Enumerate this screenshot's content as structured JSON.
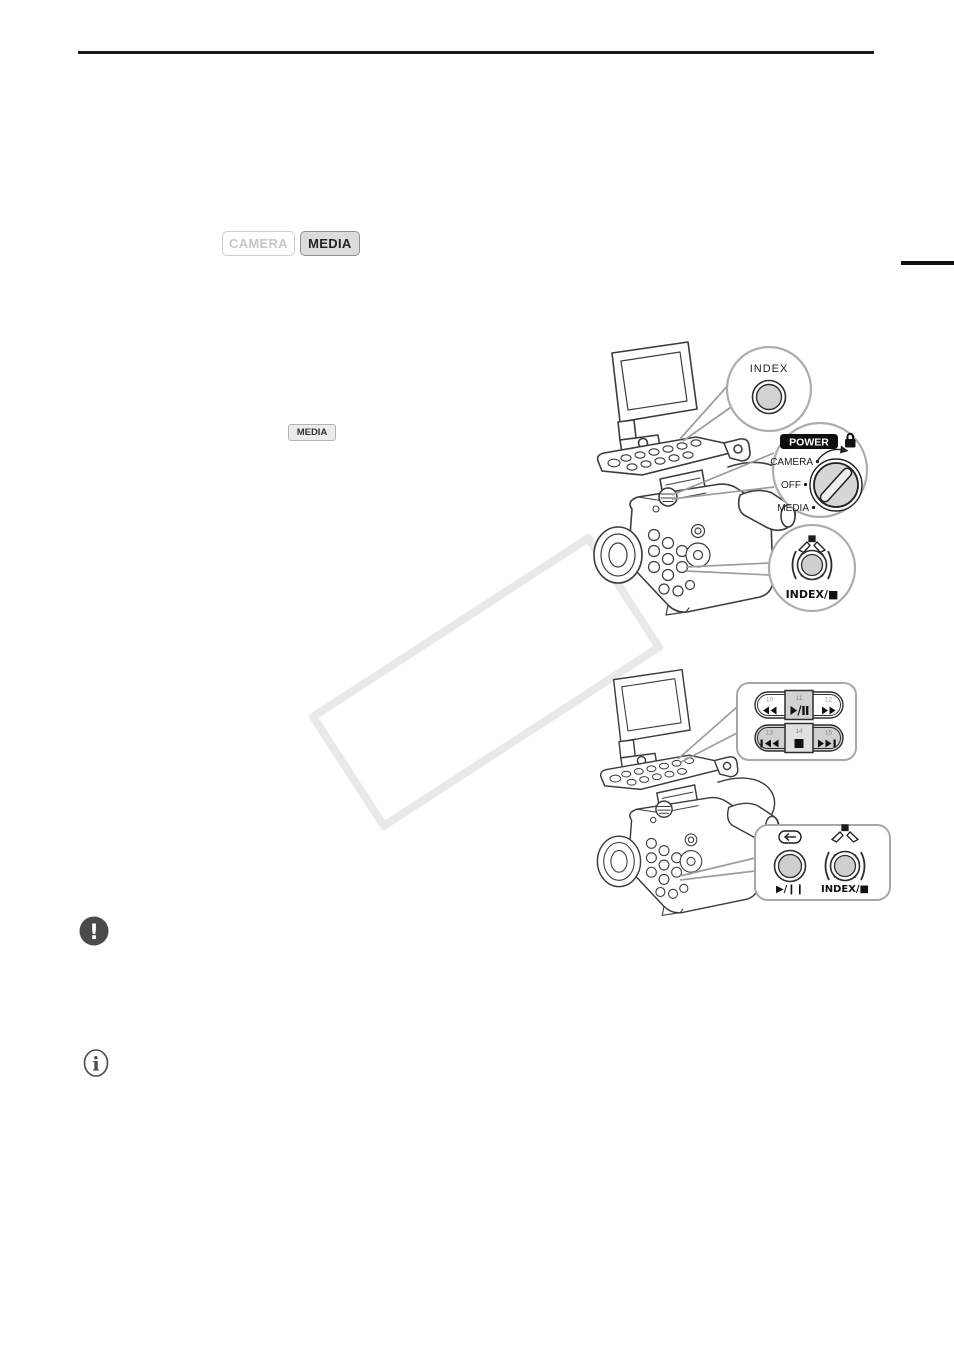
{
  "badges": {
    "camera": {
      "label": "CAMERA",
      "active": false
    },
    "media": {
      "label": "MEDIA",
      "active": true
    },
    "inline_media": {
      "label": "MEDIA"
    }
  },
  "figure1": {
    "index_callout": {
      "label": "INDEX",
      "icon": "round-button"
    },
    "power_callout": {
      "badge": "POWER",
      "positions": {
        "camera": "CAMERA",
        "off": "OFF",
        "media": "MEDIA"
      },
      "icons": [
        "lock-icon",
        "rotate-arrow-icon",
        "power-dial-icon"
      ]
    },
    "index_stop_callout": {
      "label": "INDEX/■",
      "icon": "photo-capture-icon"
    }
  },
  "figure2": {
    "playback_callout": {
      "row1": [
        {
          "num": "10",
          "icon": "fast-reverse-icon"
        },
        {
          "num": "11",
          "icon": "play-pause-icon",
          "highlighted": true
        },
        {
          "num": "12",
          "icon": "fast-forward-icon"
        }
      ],
      "row2": [
        {
          "num": "13",
          "icon": "skip-back-icon"
        },
        {
          "num": "14",
          "icon": "stop-icon"
        },
        {
          "num": "15",
          "icon": "skip-forward-icon"
        }
      ]
    },
    "body_callout": {
      "play_pause_label": "▶/❙❙",
      "index_stop_label": "INDEX/■",
      "icons": [
        "review-arrow-icon",
        "photo-capture-icon"
      ]
    }
  },
  "notes": {
    "warning_glyph": "!",
    "info_glyph": "i"
  },
  "colors": {
    "line_art": "#3c3c3c",
    "callout_border": "#adadad",
    "leader_line": "#9d9d9d",
    "button_fill": "#d2d2d2",
    "badge_active_bg": "#dcdcdc",
    "power_badge_bg": "#0d0d0d",
    "watermark": "#e9e9e9"
  }
}
